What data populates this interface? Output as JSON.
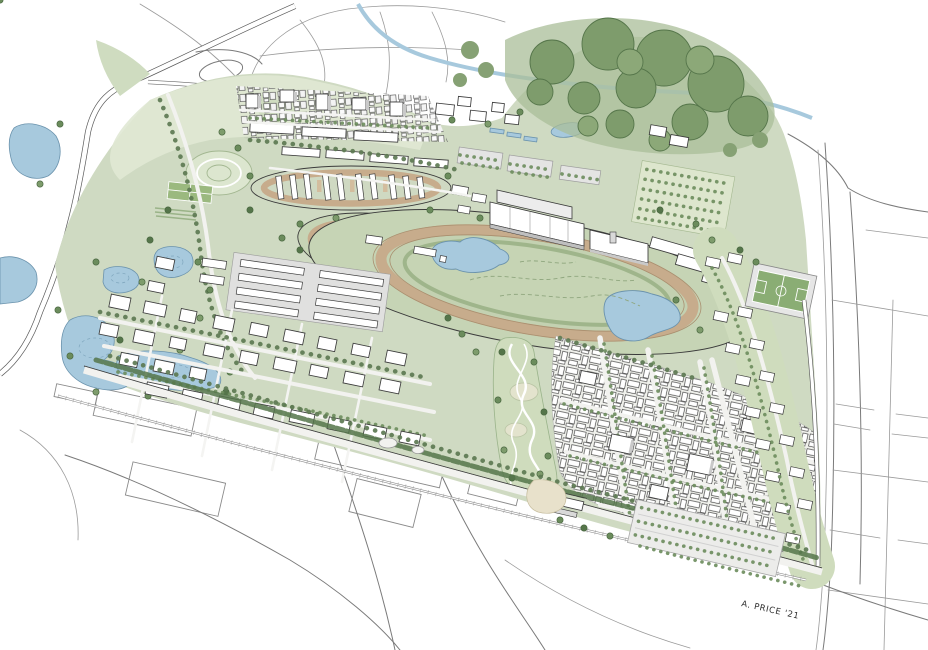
{
  "artwork": {
    "signature": "A. PRICE '21"
  },
  "palette": {
    "paper": "#ffffff",
    "plan_green": "#cfdac2",
    "light_green": "#e0e8d4",
    "infield_green": "#c6d4b5",
    "park_green": "#cfdcbd",
    "forest_wash": "#a9bd98",
    "forest_tree": "#7e9c6c",
    "tree_dark": "#55754a",
    "tree_mid": "#6b8c5c",
    "water": "#a7c9dd",
    "water_edge": "#6b93ad",
    "track_dirt": "#c7ac8c",
    "track_dirt_edge": "#a98f6f",
    "building_white": "#ffffff",
    "building_shade": "#c9c9c9",
    "ink": "#3b3b3b",
    "context_line": "#7a7a7a",
    "road_fill": "#f2f2ef",
    "plaza_beige": "#e8e1cb",
    "pitch_green": "#8aad74"
  }
}
